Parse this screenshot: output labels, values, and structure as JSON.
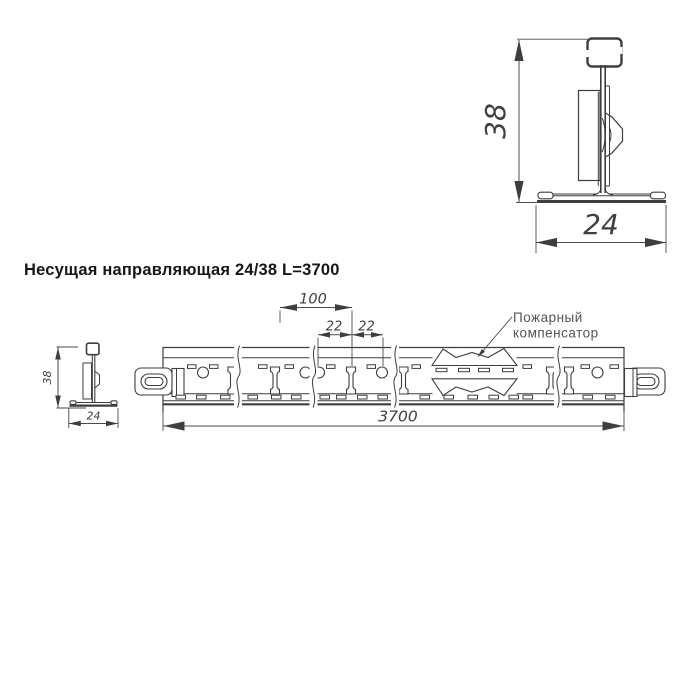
{
  "title": "Несущая направляющая 24/38 L=3700",
  "section_view": {
    "height_dim": "38",
    "width_dim": "24"
  },
  "end_view": {
    "height_dim": "38",
    "width_dim": "24"
  },
  "rail_view": {
    "dims": {
      "hole_spacing": "100",
      "offsets": [
        "22",
        "22"
      ],
      "length": "3700"
    },
    "callout": {
      "line1": "Пожарный",
      "line2": "компенсатор"
    }
  },
  "colors": {
    "background": "#ffffff",
    "line": "#3e3e3e",
    "dimension": "#4a4a4a",
    "title_text": "#161616",
    "callout_text": "#555555"
  }
}
